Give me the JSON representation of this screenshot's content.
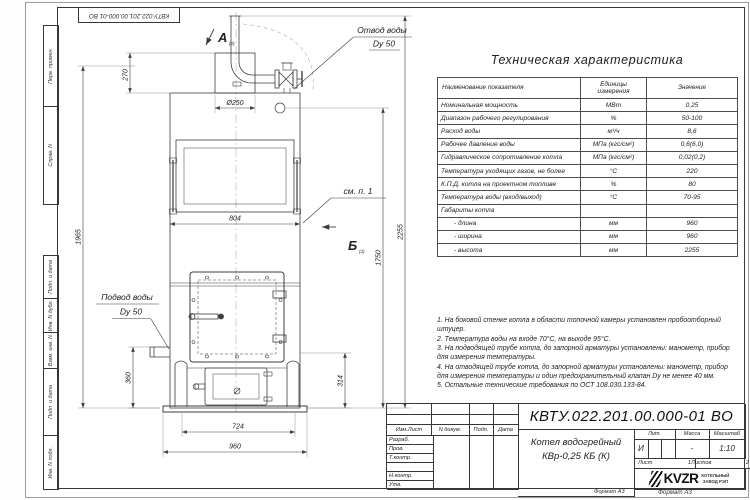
{
  "watermark": {
    "text": "KVZR.RU"
  },
  "frame": {
    "doc_number_top": "КВТУ.022.201.00.000-01 ВО",
    "margin_top_labels": [
      "Перв. примен.",
      "Справ. N"
    ],
    "margin_bottom_labels": [
      "Подп. и дата",
      "Инв. N дубл.",
      "Взам. инв. N",
      "Подп. и дата",
      "Инв. N подл."
    ]
  },
  "drawing": {
    "view_a": {
      "letter": "А",
      "sub": "(2)"
    },
    "view_b": {
      "letter": "Б",
      "sub": "(2)"
    },
    "outlet_label": {
      "line1": "Отвод воды",
      "line2": "Dy 50"
    },
    "inlet_label": {
      "line1": "Подвод воды",
      "line2": "Dy 50"
    },
    "see_note": "см. п. 1",
    "dims": {
      "top_offset": "270",
      "chimney_dia": "Ø250",
      "panel_width": "804",
      "left_height": "1965",
      "total_height": "2255",
      "body_height": "1750",
      "inlet_height": "360",
      "ash_height": "314",
      "lower_width": "724",
      "total_width": "960"
    }
  },
  "spec_table": {
    "title": "Техническая характеристика",
    "col_headers": [
      "Наименование показателя",
      "Единицы измерения",
      "Значение"
    ],
    "rows": [
      [
        "Номинальная мощность",
        "МВт",
        "0,25"
      ],
      [
        "Диапазон рабочего регулирования",
        "%",
        "50-100"
      ],
      [
        "Расход воды",
        "м³/ч",
        "8,6"
      ],
      [
        "Рабочее давление воды",
        "МПа (кгс/см²)",
        "0,6(6,0)"
      ],
      [
        "Гидравлическое сопротивление котла",
        "МПа (кгс/см²)",
        "0,02(0,2)"
      ],
      [
        "Температура уходящих газов, не более",
        "°С",
        "220"
      ],
      [
        "К.П.Д. котла на проектном топливе",
        "%",
        "80"
      ],
      [
        "Температура воды (вход/выход)",
        "°С",
        "70-95"
      ],
      [
        "Габариты котла",
        "",
        ""
      ],
      [
        "- длина",
        "мм",
        "960"
      ],
      [
        "- ширина",
        "мм",
        "960"
      ],
      [
        "- высота",
        "мм",
        "2255"
      ]
    ]
  },
  "notes": [
    "1. На боковой стенке котла в области топочной камеры установлен пробоотборный штуцер.",
    "2. Температура воды на входе 70°С, на выходе 95°С.",
    "3. На подводящей трубе котла, до запорной арматуры установлены: манометр, прибор для измерения температуры.",
    "4. На отводящей трубе котла, до запорной арматуры установлены: манометр, прибор для измерения температуры и один предохранительный клапан Dy не менее 40 мм.",
    "5. Остальные технические требования по ОСТ 108.030.133-84."
  ],
  "title_block": {
    "doc_number": "КВТУ.022.201.00.000-01 ВО",
    "product_name_line1": "Котел водогрейный",
    "product_name_line2": "КВр-0,25 КБ (К)",
    "header_cols": [
      "Изм.Лист",
      "N докум.",
      "Подп.",
      "Дата"
    ],
    "role_rows": [
      "Разраб.",
      "Пров.",
      "Т.контр.",
      "",
      "Н.контр.",
      "Утв."
    ],
    "lit_label": "Лит.",
    "lit_value": "И",
    "mass_label": "Масса",
    "mass_value": "-",
    "scale_label": "Масштаб",
    "scale_value": "1:10",
    "sheet_label": "Лист",
    "sheet_value": "1",
    "sheets_label": "Листов",
    "sheets_value": "2",
    "logo_text": "KVZR",
    "logo_sub1": "КОТЕЛЬНЫЙ",
    "logo_sub2": "ЗАВОД РЭП",
    "format_left": "Формат А3",
    "format_right": "Формат А3"
  }
}
